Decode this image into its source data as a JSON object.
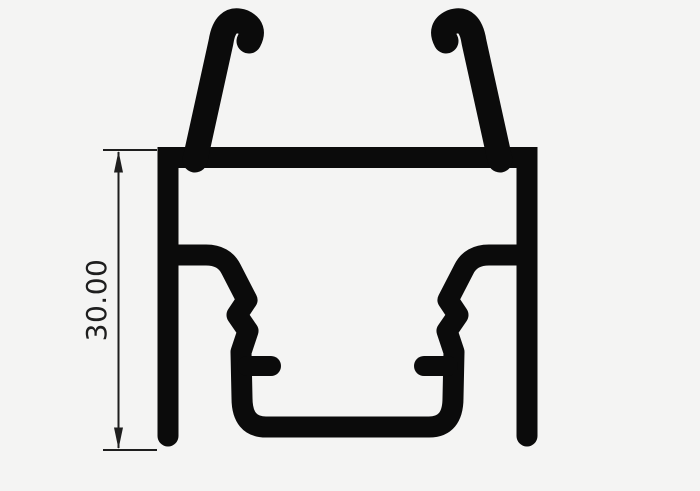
{
  "drawing": {
    "kind": "extrusion-profile-cross-section",
    "dimension": {
      "label": "30.00"
    }
  },
  "colors": {
    "bg": "#f4f4f3",
    "ink": "#0b0b0b",
    "dim": "#1e1e1e"
  }
}
